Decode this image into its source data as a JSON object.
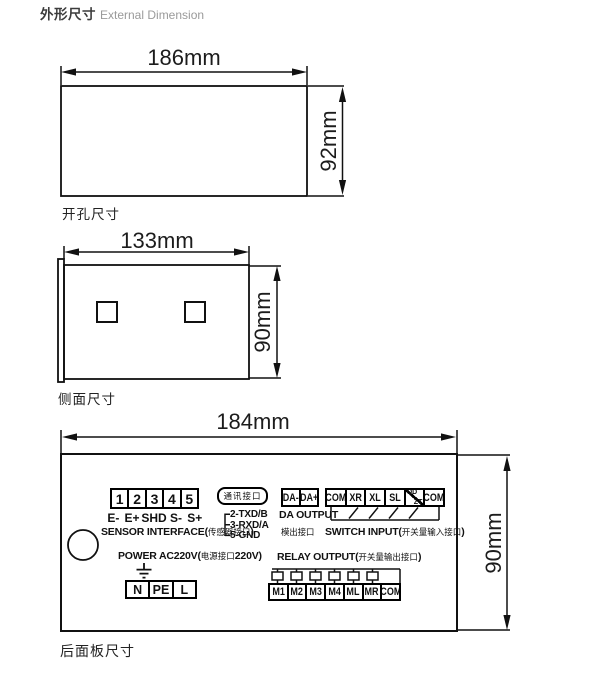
{
  "page": {
    "title_zh": "外形尺寸",
    "title_en": "External Dimension"
  },
  "fig_external": {
    "width_label": "186mm",
    "height_label": "92mm",
    "caption": "开孔尺寸"
  },
  "fig_cutout": {
    "width_label": "133mm",
    "height_label": "90mm",
    "caption": "侧面尺寸"
  },
  "rear_panel": {
    "width_label": "184mm",
    "height_label": "90mm",
    "caption": "后面板尺寸",
    "sensor": {
      "terminals": [
        "1",
        "2",
        "3",
        "4",
        "5"
      ],
      "pins": [
        "E-",
        "E+",
        "SHD",
        "S-",
        "S+"
      ],
      "label_en": "SENSOR INTERFACE(",
      "label_zh": "传感器接口",
      "label_close": ")"
    },
    "comm": {
      "port_label": "通讯接口",
      "pins": [
        "2-TXD/B",
        "3-RXD/A",
        "5-GND"
      ]
    },
    "da": {
      "terminals": [
        "DA-",
        "DA+"
      ],
      "label_en": "DA OUTPUT",
      "label_zh": "模出接口"
    },
    "switch_input": {
      "terminals": [
        "COM",
        "XR",
        "XL",
        "SL",
        "QD/ZT",
        "COM"
      ],
      "split_top": "QD",
      "split_bottom": "ZT",
      "label_en": "SWITCH INPUT(",
      "label_zh": "开关量输入接口",
      "label_close": ")"
    },
    "power": {
      "label_en": "POWER AC220V(",
      "label_zh": "电源接口",
      "label_v": "220V)",
      "terminals": [
        "N",
        "PE",
        "L"
      ]
    },
    "relay": {
      "label_en": "RELAY OUTPUT(",
      "label_zh": "开关量输出接口",
      "label_close": ")",
      "terminals": [
        "M1",
        "M2",
        "M3",
        "M4",
        "ML",
        "MR",
        "COM"
      ]
    }
  }
}
